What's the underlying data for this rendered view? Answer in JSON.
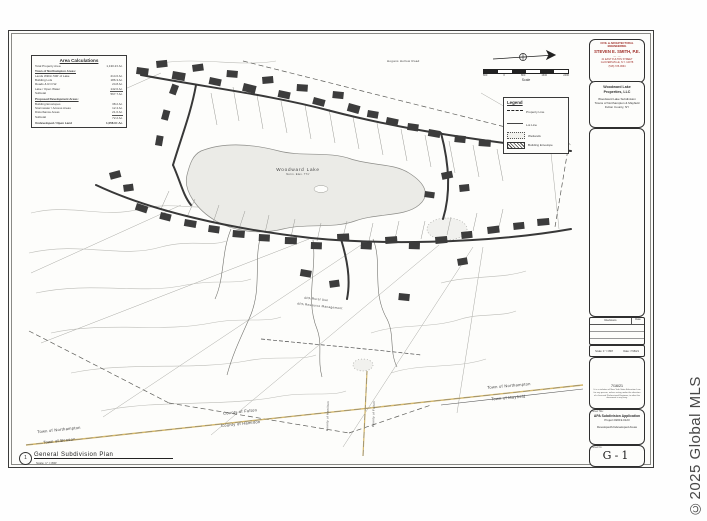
{
  "watermark": "©2025 Global MLS",
  "area_calc": {
    "title": "Area Calculations",
    "rows": [
      {
        "t": "Total Property Area",
        "v": "1,130.2± Ac."
      },
      {
        "t": "Town of Northampton Areas:",
        "v": ""
      },
      {
        "t": "Lands Within 500' of Lake",
        "v": "214.6 Ac."
      },
      {
        "t": "Building Lots",
        "v": "186.3 Ac."
      },
      {
        "t": "Roads & R.O.W.",
        "v": "24.8 Ac."
      },
      {
        "t": "Lake / Open Water",
        "v": "142.0 Ac."
      },
      {
        "t": "Subtotal",
        "v": "567.7 Ac."
      },
      {
        "t": "Proposed Development Areas:",
        "v": ""
      },
      {
        "t": "Building Envelopes",
        "v": "38.2 Ac."
      },
      {
        "t": "Stormwater / Access Areas",
        "v": "12.4 Ac."
      },
      {
        "t": "Disturbance Areas",
        "v": "21.6 Ac."
      },
      {
        "t": "Subtotal",
        "v": "72.2 Ac."
      },
      {
        "t": "Undeveloped / Open Land",
        "v": "1,058.0± Ac."
      }
    ]
  },
  "legend": {
    "title": "Legend",
    "items": [
      {
        "label": "Property Line"
      },
      {
        "label": "Lot Line"
      },
      {
        "label": "Wetlands"
      },
      {
        "label": "Building Envelope"
      }
    ]
  },
  "scale_bar": {
    "label": "Scale",
    "ticks": [
      "800",
      "0",
      "800",
      "1600",
      "2400"
    ]
  },
  "map": {
    "lake_label": "Woodward Lake",
    "lake_sub": "Norm. Elev. 771'",
    "top_right_road": "Hogans Hollow Road",
    "apa_line1": "APA Rural Use",
    "apa_line2": "APA Resource Management",
    "bnd_ne_top": "Town of Northampton",
    "bnd_ne_bot": "Town of Mayfield",
    "bnd_cty_top": "County of Fulton",
    "bnd_cty_bot": "County of Hamilton",
    "bnd_sw_top": "Town of Northampton",
    "bnd_sw_bot": "Town of Benson",
    "bnd_vert_left": "County of Hamilton",
    "bnd_vert_right": "County of Fulton",
    "plan_number": "1",
    "plan_title": "General Subdivision Plan",
    "plan_scale": "Scale: 1\" = 800'"
  },
  "title_block": {
    "engineer": {
      "firm_type": "CIVIL & ARCHITECTURAL\nENGINEERING",
      "name": "STEVEN E. SMITH, P.E.",
      "divider": "— · —",
      "address": "41 EAST FULTON STREET\nGLOVERSVILLE, N.Y. 12078\n(518) 725-0664"
    },
    "client": "Woodward Lake\nProperties, LLC",
    "project": "Woodward Lake Subdivision\nTowns of Northampton & Mayfield\nFulton County, NY",
    "revisions": {
      "col1": "Revisions",
      "col2": "Date"
    },
    "fields": {
      "scale": "Scale: 1\" = 800'",
      "date": "Date: 7/16/21"
    },
    "stamp_date": "7/16/21",
    "note": "It is a violation of New York State Education Law for any person, unless acting under the direction of a licensed Professional Engineer, to alter this document in any way.",
    "sheet_title_label": "Sheet Title:",
    "sheet_title1": "APA Subdivision Application",
    "sheet_title2": "Project #2019-0123",
    "sheet_title3": "Developed/Undeveloped Areas",
    "sheet_no_label": "Sheet No.",
    "sheet_no": "G-1"
  }
}
